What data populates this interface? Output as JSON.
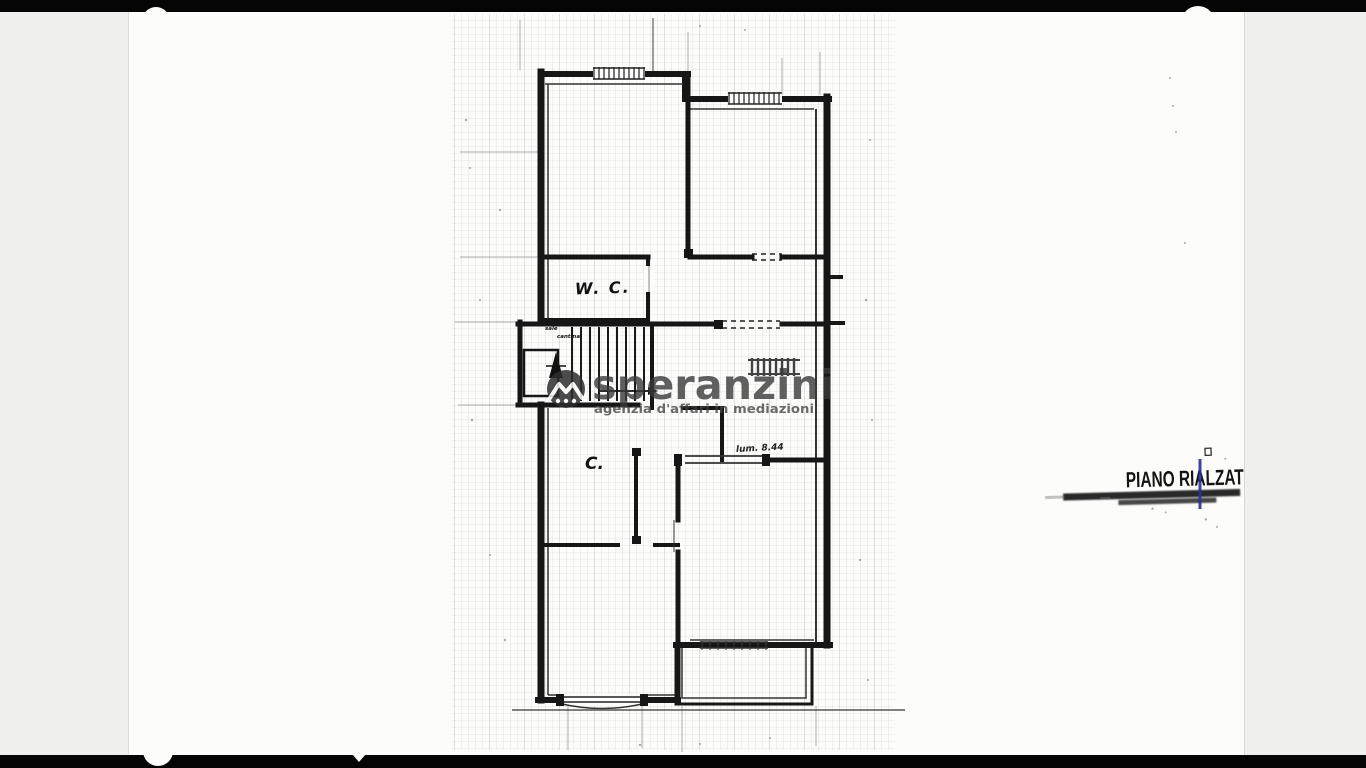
{
  "scan": {
    "paper_color": "#fcfcfb",
    "margin_color": "#f0f0ee",
    "edge_bar_color": "#050505",
    "ink_color": "#1a1a1a"
  },
  "plan": {
    "labels": {
      "wc": "W. C.",
      "room_c": "C.",
      "dimension_note": "lum. 8.44",
      "stair_note_1": "sale",
      "stair_note_2": "cantina"
    }
  },
  "watermark": {
    "brand": "speranzini",
    "tagline": "agenzia d'affari in mediazioni",
    "logo_icon": "house-roof-icon",
    "color": "#3a3a3a"
  },
  "stamp": {
    "text": "PIANO RIALZAT",
    "ink_color": "#141414",
    "pen_mark_color": "#2e2e96"
  }
}
